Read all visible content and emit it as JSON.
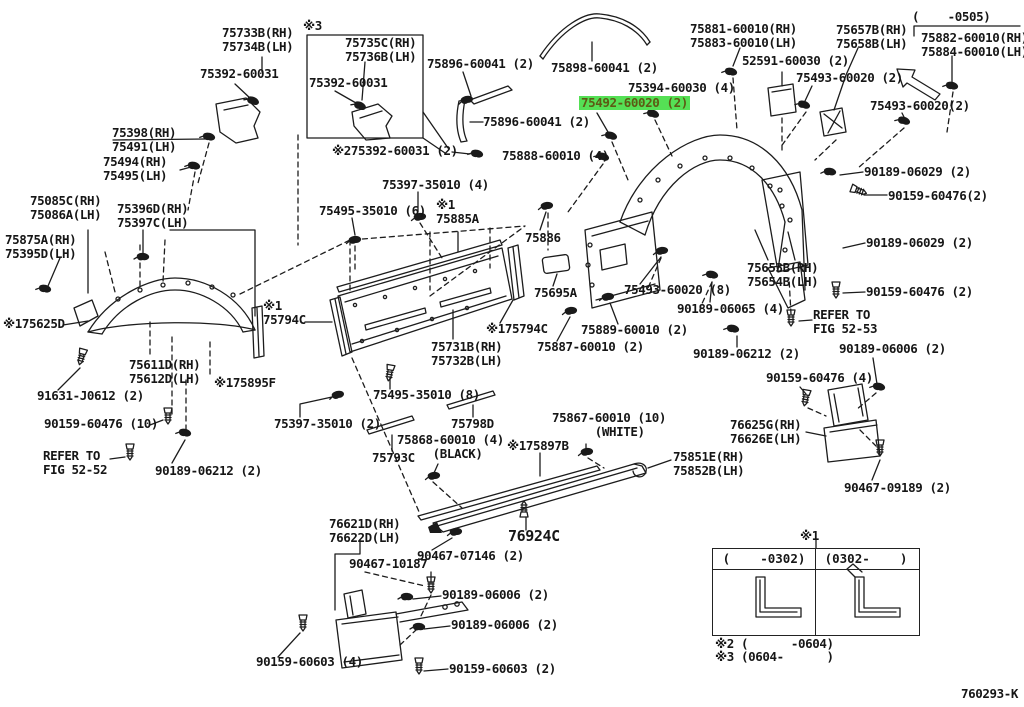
{
  "diagram": {
    "code": "760293-K",
    "highlight_color": "#55e055",
    "table": {
      "mark": "※1",
      "col_left": "(    -0302)",
      "col_right": "(0302-    )",
      "note2": "※2 (      -0604)",
      "note3": "※3 (0604-      )"
    },
    "labels": [
      {
        "n": "part-75733",
        "t": "75733B(RH)\n75734B(LH)",
        "x": 222,
        "y": 26
      },
      {
        "n": "mark-3",
        "t": "※3",
        "x": 303,
        "y": 19
      },
      {
        "n": "part-75735",
        "t": "75735C(RH)\n75736B(LH)",
        "x": 345,
        "y": 36
      },
      {
        "n": "part-75392-a",
        "t": "75392-60031",
        "x": 200,
        "y": 67
      },
      {
        "n": "part-75392-b",
        "t": "75392-60031",
        "x": 309,
        "y": 76
      },
      {
        "n": "part-75896-a",
        "t": "75896-60041 (2)",
        "x": 427,
        "y": 57
      },
      {
        "n": "part-75898",
        "t": "75898-60041 (2)",
        "x": 551,
        "y": 61
      },
      {
        "n": "part-75881",
        "t": "75881-60010(RH)\n75883-60010(LH)",
        "x": 690,
        "y": 22
      },
      {
        "n": "part-75657",
        "t": "75657B(RH)\n75658B(LH)",
        "x": 836,
        "y": 23
      },
      {
        "n": "range-0505",
        "t": "(    -0505)",
        "x": 912,
        "y": 10
      },
      {
        "n": "part-75882",
        "t": "75882-60010(RH)\n75884-60010(LH)",
        "x": 921,
        "y": 31
      },
      {
        "n": "part-52591",
        "t": "52591-60030 (2)",
        "x": 742,
        "y": 54
      },
      {
        "n": "part-75493-a",
        "t": "75493-60020 (2)",
        "x": 796,
        "y": 71
      },
      {
        "n": "part-75493-b",
        "t": "75493-60020(2)",
        "x": 870,
        "y": 99
      },
      {
        "n": "part-75394",
        "t": "75394-60030 (4)",
        "x": 628,
        "y": 81
      },
      {
        "n": "part-75492-highlighted",
        "t": "75492-60020 (2)",
        "x": 579,
        "y": 96,
        "hl": true
      },
      {
        "n": "part-75896-b",
        "t": "75896-60041 (2)",
        "x": 483,
        "y": 115
      },
      {
        "n": "part-275392",
        "t": "※275392-60031 (2)",
        "x": 332,
        "y": 144
      },
      {
        "n": "part-75888",
        "t": "75888-60010 (4)",
        "x": 502,
        "y": 149
      },
      {
        "n": "part-75398",
        "t": "75398(RH)\n75491(LH)",
        "x": 112,
        "y": 126
      },
      {
        "n": "part-75494",
        "t": "75494(RH)\n75495(LH)",
        "x": 103,
        "y": 155
      },
      {
        "n": "part-75397-35010-4",
        "t": "75397-35010 (4)",
        "x": 382,
        "y": 178
      },
      {
        "n": "part-75495-35010-6",
        "t": "75495-35010 (6)",
        "x": 319,
        "y": 204
      },
      {
        "n": "part-75885",
        "t": "※1\n75885A",
        "x": 436,
        "y": 198
      },
      {
        "n": "part-75085",
        "t": "75085C(RH)\n75086A(LH)",
        "x": 30,
        "y": 194
      },
      {
        "n": "part-75396",
        "t": "75396D(RH)\n75397C(LH)",
        "x": 117,
        "y": 202
      },
      {
        "n": "part-75875",
        "t": "75875A(RH)\n75395D(LH)",
        "x": 5,
        "y": 233
      },
      {
        "n": "part-75886",
        "t": "75886",
        "x": 525,
        "y": 231
      },
      {
        "n": "part-75653",
        "t": "75653B(RH)\n75654B(LH)",
        "x": 747,
        "y": 261
      },
      {
        "n": "part-90189-06029-a",
        "t": "90189-06029 (2)",
        "x": 864,
        "y": 165
      },
      {
        "n": "part-90159-60476-a",
        "t": "90159-60476(2)",
        "x": 888,
        "y": 189
      },
      {
        "n": "part-90189-06029-b",
        "t": "90189-06029 (2)",
        "x": 866,
        "y": 236
      },
      {
        "n": "part-90159-60476-b",
        "t": "90159-60476 (2)",
        "x": 866,
        "y": 285
      },
      {
        "n": "part-75695",
        "t": "75695A",
        "x": 534,
        "y": 286
      },
      {
        "n": "part-75493-8",
        "t": "75493-60020 (8)",
        "x": 624,
        "y": 283
      },
      {
        "n": "part-90189-06065",
        "t": "90189-06065 (4)",
        "x": 677,
        "y": 302
      },
      {
        "n": "mark-175625",
        "t": "※175625D",
        "x": 3,
        "y": 317
      },
      {
        "n": "part-75794-left",
        "t": "※1\n75794C",
        "x": 263,
        "y": 299
      },
      {
        "n": "part-175794-mid",
        "t": "※175794C",
        "x": 486,
        "y": 322
      },
      {
        "n": "part-75731",
        "t": "75731B(RH)\n75732B(LH)",
        "x": 431,
        "y": 340
      },
      {
        "n": "part-75889",
        "t": "75889-60010 (2)",
        "x": 581,
        "y": 323
      },
      {
        "n": "part-75887",
        "t": "75887-60010 (2)",
        "x": 537,
        "y": 340
      },
      {
        "n": "part-90189-06212-r",
        "t": "90189-06212 (2)",
        "x": 693,
        "y": 347
      },
      {
        "n": "part-90159-60476-4r",
        "t": "90159-60476 (4)",
        "x": 766,
        "y": 371
      },
      {
        "n": "refer-fig-52-53",
        "t": "REFER TO\nFIG 52-53",
        "x": 813,
        "y": 308
      },
      {
        "n": "part-90189-06006-r",
        "t": "90189-06006 (2)",
        "x": 839,
        "y": 342
      },
      {
        "n": "mark-175895",
        "t": "※175895F",
        "x": 214,
        "y": 376
      },
      {
        "n": "part-75495-35010-8",
        "t": "75495-35010 (8)",
        "x": 373,
        "y": 388
      },
      {
        "n": "part-75397-35010-2",
        "t": "75397-35010 (2)",
        "x": 274,
        "y": 417
      },
      {
        "n": "part-75798",
        "t": "75798D",
        "x": 451,
        "y": 417
      },
      {
        "n": "part-75868",
        "t": "75868-60010 (4)\n     (BLACK)",
        "x": 397,
        "y": 433
      },
      {
        "n": "part-75793",
        "t": "75793C",
        "x": 372,
        "y": 451
      },
      {
        "n": "part-75867",
        "t": "75867-60010 (10)\n      (WHITE)",
        "x": 552,
        "y": 411
      },
      {
        "n": "mark-175897",
        "t": "※175897B",
        "x": 507,
        "y": 439
      },
      {
        "n": "part-75851",
        "t": "75851E(RH)\n75852B(LH)",
        "x": 673,
        "y": 450
      },
      {
        "n": "part-76625",
        "t": "76625G(RH)\n76626E(LH)",
        "x": 730,
        "y": 418
      },
      {
        "n": "part-90467-09189",
        "t": "90467-09189 (2)",
        "x": 844,
        "y": 481
      },
      {
        "n": "part-76621",
        "t": "76621D(RH)\n76622D(LH)",
        "x": 329,
        "y": 517
      },
      {
        "n": "part-90467-07146",
        "t": "90467-07146 (2)",
        "x": 417,
        "y": 549
      },
      {
        "n": "part-76924",
        "t": "76924C",
        "x": 508,
        "y": 528,
        "lg": true
      },
      {
        "n": "part-90467-10187",
        "t": "90467-10187",
        "x": 349,
        "y": 557
      },
      {
        "n": "part-90189-06006-b1",
        "t": "90189-06006 (2)",
        "x": 442,
        "y": 588
      },
      {
        "n": "part-90189-06006-b2",
        "t": "90189-06006 (2)",
        "x": 451,
        "y": 618
      },
      {
        "n": "part-90159-60603-4",
        "t": "90159-60603 (4)",
        "x": 256,
        "y": 655
      },
      {
        "n": "part-90159-60603-2",
        "t": "90159-60603 (2)",
        "x": 449,
        "y": 662
      },
      {
        "n": "part-90159-60476-10",
        "t": "90159-60476 (10)",
        "x": 44,
        "y": 417
      },
      {
        "n": "refer-fig-52-52",
        "t": "REFER TO\nFIG 52-52",
        "x": 43,
        "y": 449
      },
      {
        "n": "part-90189-06212-l",
        "t": "90189-06212 (2)",
        "x": 155,
        "y": 464
      },
      {
        "n": "part-91631",
        "t": "91631-J0612 (2)",
        "x": 37,
        "y": 389
      },
      {
        "n": "part-75611",
        "t": "75611D(RH)\n75612D(LH)",
        "x": 129,
        "y": 358
      }
    ]
  }
}
